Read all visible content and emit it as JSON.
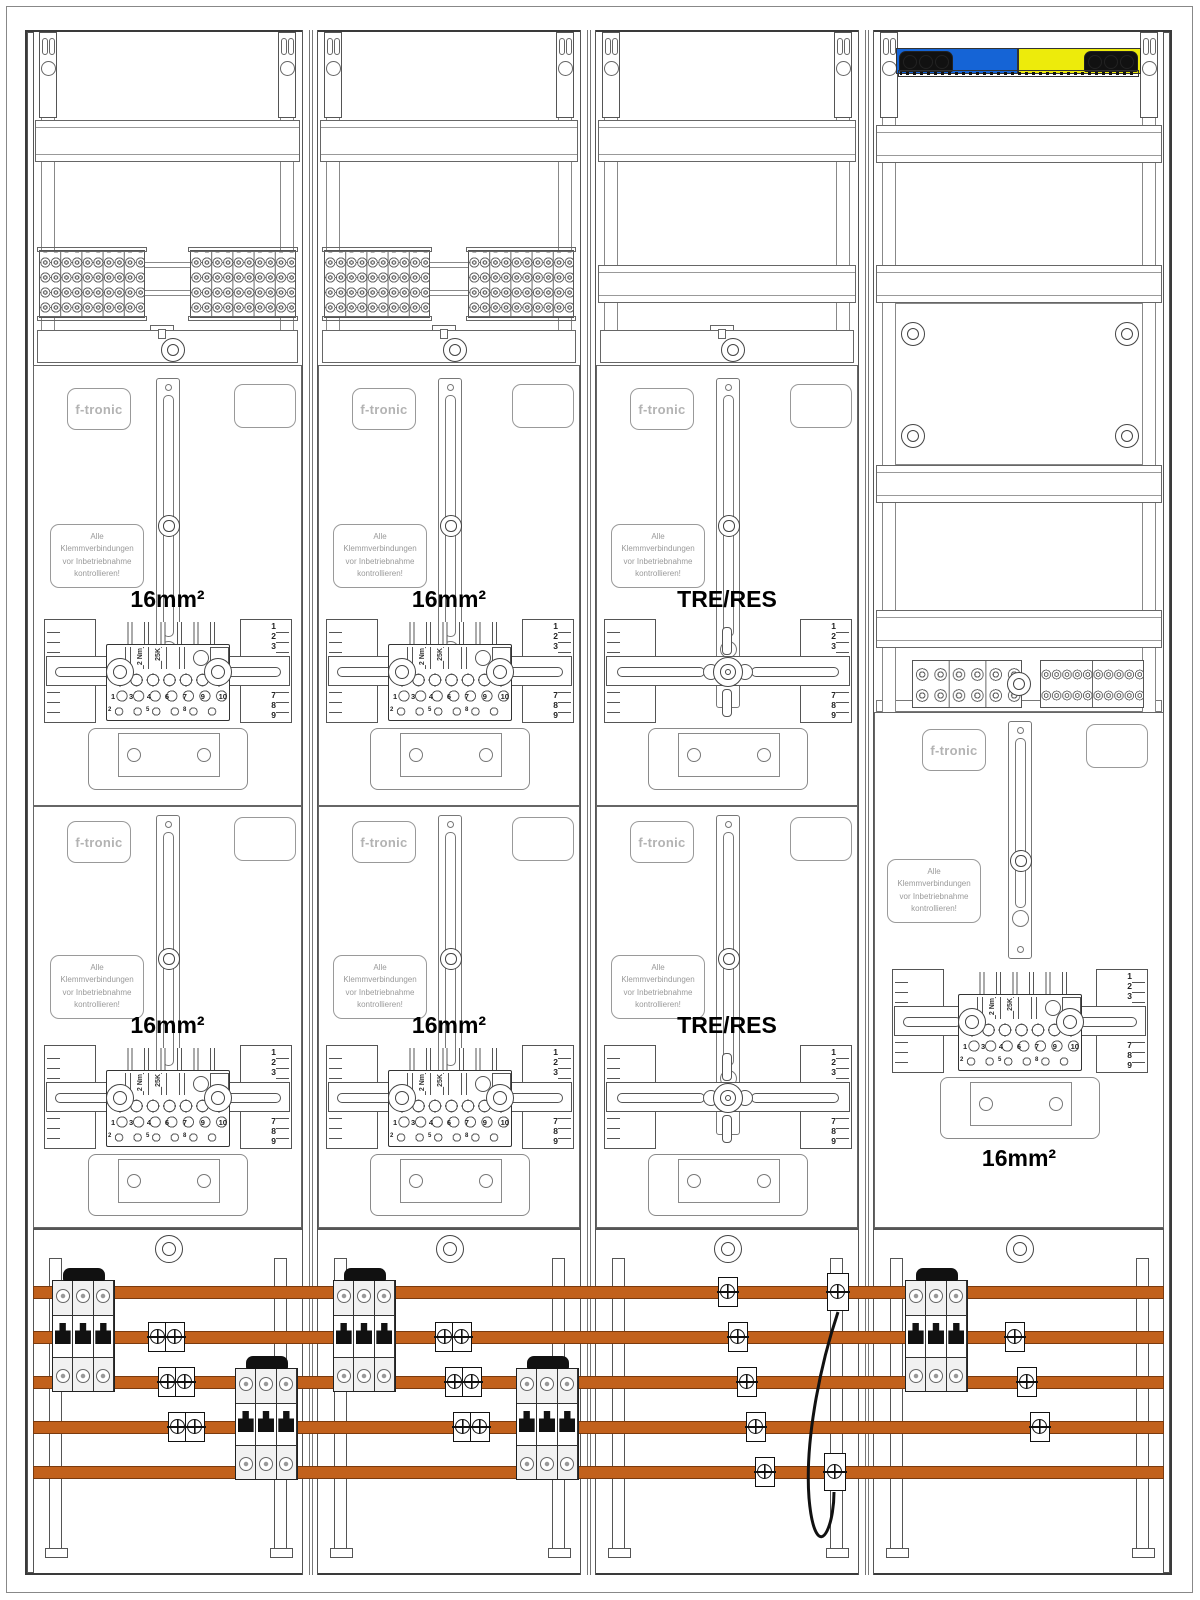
{
  "brand": {
    "logo": "f-tronic"
  },
  "warning": {
    "l1": "Alle Klemmverbindungen",
    "l2": "vor Inbetriebnahme",
    "l3": "kontrollieren!"
  },
  "labels": {
    "m16": "16mm²",
    "tre": "TRE/RES"
  },
  "block": {
    "torque": "2 Nm",
    "code": "25K",
    "numbers": [
      "1",
      "3",
      "4",
      "6",
      "7",
      "9",
      "10"
    ],
    "small": [
      "2",
      "5",
      "8"
    ]
  },
  "ruler": {
    "top": [
      "1",
      "2",
      "3"
    ],
    "mid": "5",
    "bottom": [
      "7",
      "8",
      "9"
    ]
  },
  "colors": {
    "busbar_orange": "#C2611C",
    "neutral_blue": "#1564D6",
    "pe_yellow": "#EDEB0B"
  }
}
